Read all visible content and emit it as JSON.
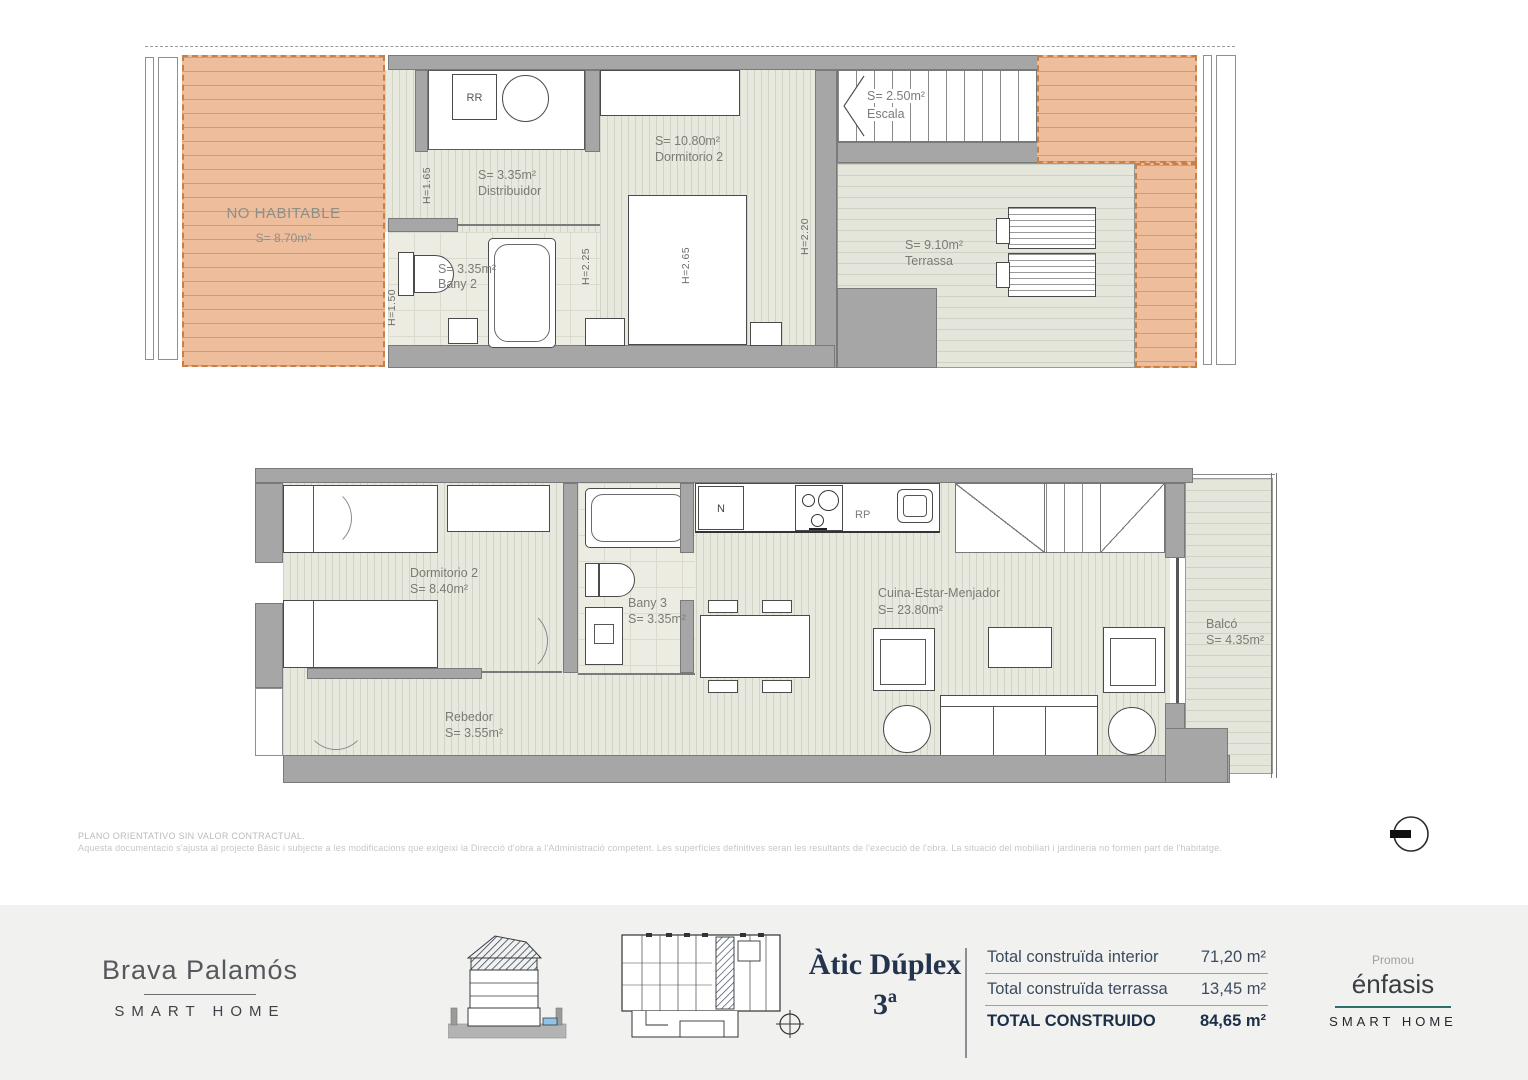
{
  "plan_footnote": {
    "line1": "PLANO ORIENTATIVO SIN VALOR CONTRACTUAL.",
    "line2": "Aquesta documentació s'ajusta al projecte Bàsic i subjecte a les modificacions que exigeixi la Direcció d'obra a l'Administració competent. Les superfícies definitives seran les resultants de l'execució de l'obra. La situació del mobiliari i jardineria no formen part de l'habitatge."
  },
  "upper_plan": {
    "no_habitable": {
      "name": "NO HABITABLE",
      "area": "S= 8.70m²"
    },
    "rr_label": "RR",
    "distribuidor": {
      "area": "S= 3.35m²",
      "name": "Distribuidor"
    },
    "bany2": {
      "area": "S= 3.35m²",
      "name": "Bany 2"
    },
    "dormitorio2": {
      "area": "S= 10.80m²",
      "name": "Dormitorio 2"
    },
    "escala": {
      "area": "S= 2.50m²",
      "name": "Escala"
    },
    "terrassa": {
      "area": "S= 9.10m²",
      "name": "Terrassa"
    },
    "heights": {
      "h165": "H=1.65",
      "h150": "H=1.50",
      "h225": "H=2.25",
      "h265": "H=2.65",
      "h220": "H=2.20"
    }
  },
  "lower_plan": {
    "dormitorio2": {
      "name": "Dormitorio 2",
      "area": "S= 8.40m²"
    },
    "bany3": {
      "name": "Bany 3",
      "area": "S= 3.35m²"
    },
    "rebedor": {
      "name": "Rebedor",
      "area": "S= 3.55m²"
    },
    "cuina": {
      "name": "Cuina-Estar-Menjador",
      "area": "S= 23.80m²"
    },
    "balco": {
      "name": "Balcó",
      "area": "S= 4.35m²"
    },
    "n_label": "N",
    "rp_label": "RP"
  },
  "footer": {
    "brand": {
      "title": "Brava Palamós",
      "subtitle": "SMART HOME"
    },
    "unit": {
      "title": "Àtic Dúplex",
      "floor": "3ª"
    },
    "totals": {
      "row1": {
        "label": "Total construïda interior",
        "value": "71,20 m²"
      },
      "row2": {
        "label": "Total construïda terrassa",
        "value": "13,45 m²"
      },
      "row3": {
        "label": "TOTAL CONSTRUIDO",
        "value": "84,65 m²"
      }
    },
    "promoter": {
      "pre": "Promou",
      "name": "énfasis",
      "subtitle": "SMART HOME"
    }
  },
  "colors": {
    "deck_orange": "#edbd9c",
    "floor_green_gray": "#e7e8de",
    "wall_gray": "#a6a6a6",
    "navy": "#24344f",
    "teal_underline": "#2f6f6b",
    "footer_bg": "#f1f1ef"
  }
}
